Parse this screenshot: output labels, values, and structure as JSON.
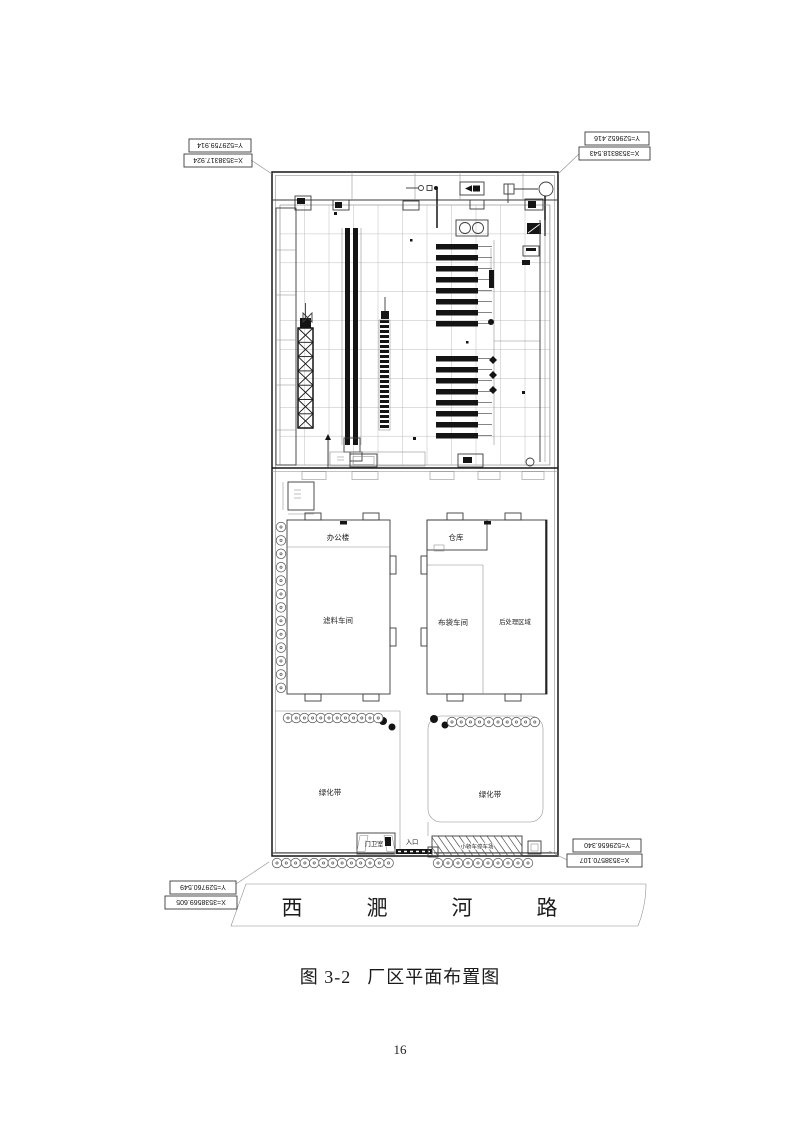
{
  "figure": {
    "caption_label": "图 3-2",
    "caption_title": "厂区平面布置图",
    "page_number": "16"
  },
  "site_plan": {
    "coordinates": {
      "top_left": {
        "x": "X=3538317.924",
        "y": "Y=529759.914"
      },
      "top_right": {
        "x": "X=3538318.543",
        "y": "Y=529652.416"
      },
      "bottom_right": {
        "x": "X=3538570.107",
        "y": "Y=529656.340"
      },
      "bottom_left": {
        "x": "X=3538569.605",
        "y": "Y=529760.549"
      }
    },
    "labels": {
      "office": "办公楼",
      "filter_workshop": "滤料车间",
      "warehouse": "仓库",
      "bag_workshop": "布袋车间",
      "post_processing": "后处理区域",
      "green_belt_left": "绿化带",
      "green_belt_right": "绿化带",
      "guard_room": "门卫室",
      "entrance": "入口",
      "parking": "小轿车停车场"
    },
    "road": {
      "name": "西淝河路",
      "chars": [
        "西",
        "淝",
        "河",
        "路"
      ]
    }
  }
}
